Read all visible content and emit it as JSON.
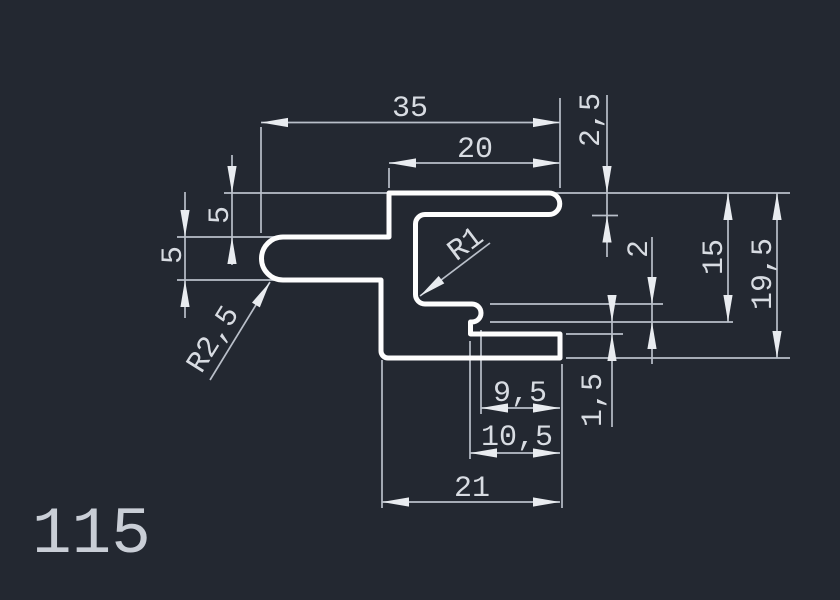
{
  "drawing": {
    "profile_number": "115",
    "dims": {
      "total_width": "35",
      "top_width": "20",
      "top_thickness": "2,5",
      "top_offset": "5",
      "arm_thickness": "5",
      "inner_radius": "R1",
      "arm_radius": "R2,5",
      "hook_thickness": "2",
      "hook_depth": "15",
      "total_height": "19,5",
      "slot_gap": "1,5",
      "slot_width": "9,5",
      "hook_width": "10,5",
      "bottom_width": "21"
    },
    "colors": {
      "background": "#232831",
      "profile_stroke": "#fdfdfd",
      "dimension_stroke": "#b9bfc9",
      "text": "#d8dce2"
    }
  }
}
